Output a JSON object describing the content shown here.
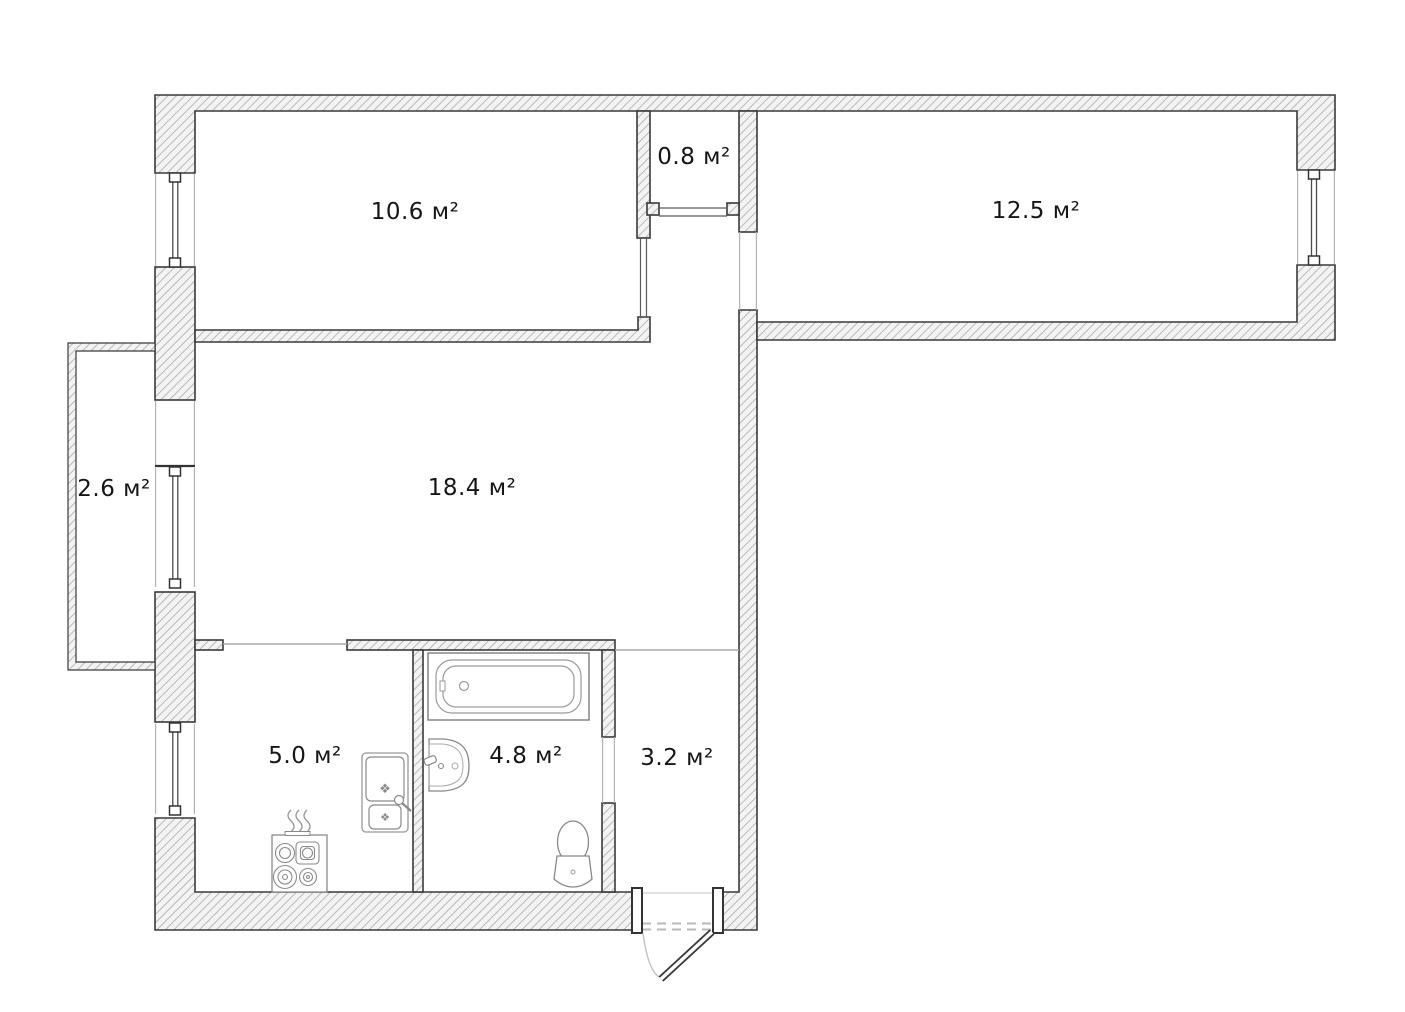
{
  "plan": {
    "title": "apartment-floor-plan",
    "background": "#ffffff",
    "wall_outline_color": "#3a3a3a",
    "hatch_color": "#ababab",
    "label_color": "#161616",
    "area_unit": "м²",
    "drain_glyph": "❖",
    "rooms": [
      {
        "name": "bedroom-top-left",
        "area_label": "10.6 м²"
      },
      {
        "name": "storage-closet",
        "area_label": "0.8 м²"
      },
      {
        "name": "bedroom-top-right",
        "area_label": "12.5 м²"
      },
      {
        "name": "balcony",
        "area_label": "2.6 м²"
      },
      {
        "name": "living-room",
        "area_label": "18.4 м²"
      },
      {
        "name": "kitchen",
        "area_label": "5.0 м²"
      },
      {
        "name": "bathroom",
        "area_label": "4.8 м²"
      },
      {
        "name": "hallway",
        "area_label": "3.2 м²"
      }
    ],
    "fixtures": [
      {
        "name": "bathtub"
      },
      {
        "name": "washbasin"
      },
      {
        "name": "toilet"
      },
      {
        "name": "gas-stove"
      },
      {
        "name": "kitchen-sink"
      },
      {
        "name": "entrance-door"
      }
    ]
  }
}
